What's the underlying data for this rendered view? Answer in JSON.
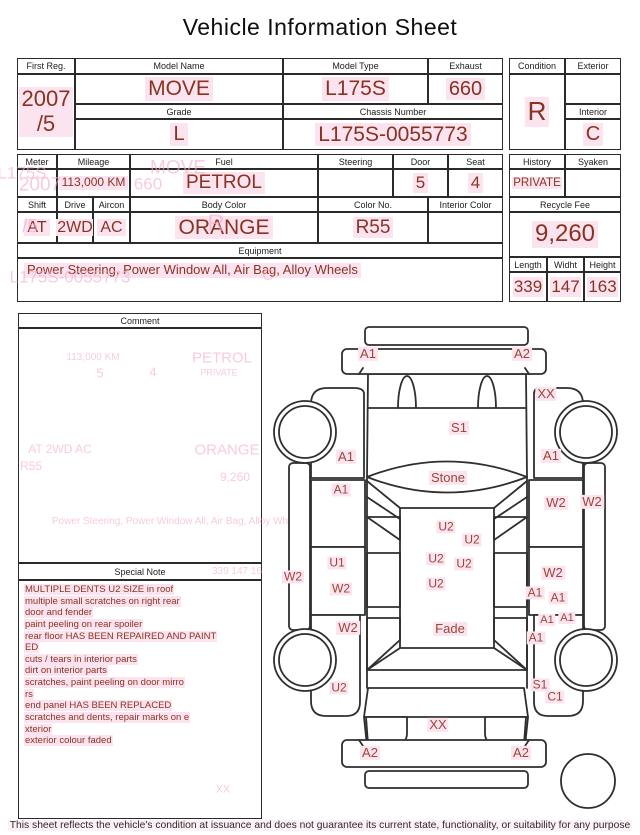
{
  "title": "Vehicle Information Sheet",
  "registration": {
    "first_reg": {
      "label": "First Reg.",
      "value": "2007\n/5"
    },
    "model_name": {
      "label": "Model Name",
      "value": "MOVE"
    },
    "model_type": {
      "label": "Model Type",
      "value": "L175S"
    },
    "exhaust": {
      "label": "Exhaust",
      "value": "660"
    },
    "grade": {
      "label": "Grade",
      "value": "L"
    },
    "chassis_number": {
      "label": "Chassis Number",
      "value": "L175S-0055773"
    },
    "condition": {
      "label": "Condition",
      "value": "R"
    },
    "exterior": {
      "label": "Exterior",
      "value": ""
    },
    "interior": {
      "label": "Interior",
      "value": "C"
    }
  },
  "details": {
    "meter": {
      "label": "Meter",
      "value": ""
    },
    "mileage": {
      "label": "Mileage",
      "value": "113,000 KM"
    },
    "fuel": {
      "label": "Fuel",
      "value": "PETROL"
    },
    "steering": {
      "label": "Steering",
      "value": ""
    },
    "door": {
      "label": "Door",
      "value": "5"
    },
    "seat": {
      "label": "Seat",
      "value": "4"
    },
    "shift": {
      "label": "Shift",
      "value": "AT"
    },
    "drive": {
      "label": "Drive",
      "value": "2WD"
    },
    "aircon": {
      "label": "Aircon",
      "value": "AC"
    },
    "body_color": {
      "label": "Body Color",
      "value": "ORANGE"
    },
    "color_no": {
      "label": "Color No.",
      "value": "R55"
    },
    "interior_color": {
      "label": "Interior Color",
      "value": ""
    },
    "equipment": {
      "label": "Equipment",
      "value": "Power Steering, Power Window  All, Air Bag, Alloy Wheels"
    },
    "history": {
      "label": "History",
      "value": "PRIVATE"
    },
    "syaken": {
      "label": "Syaken",
      "value": ""
    },
    "recycle_fee": {
      "label": "Recycle Fee",
      "value": "9,260"
    },
    "length": {
      "label": "Length",
      "value": "339"
    },
    "width": {
      "label": "Widht",
      "value": "147"
    },
    "height": {
      "label": "Height",
      "value": "163"
    }
  },
  "comment": {
    "label": "Comment"
  },
  "special_note": {
    "label": "Special Note",
    "lines": [
      "MULTIPLE DENTS U2 SIZE in roof",
      "multiple small scratches on right rear",
      " door and fender",
      "paint peeling on rear spoiler",
      "rear floor HAS BEEN REPAIRED AND PAINT",
      "ED",
      "cuts / tears in interior parts",
      "dirt on interior parts",
      "scratches, paint peeling on door mirro",
      "rs",
      "end panel HAS BEEN REPLACED",
      "scratches and dents, repair marks on e",
      "xterior",
      "exterior colour faded"
    ]
  },
  "footer": "This sheet reflects the vehicle's condition at issuance and does not guarantee its current state, functionality, or suitability for any purpose",
  "diagram": {
    "labels": [
      {
        "t": "A1",
        "x": 368,
        "y": 354,
        "s": 13
      },
      {
        "t": "A2",
        "x": 522,
        "y": 354,
        "s": 13
      },
      {
        "t": "XX",
        "x": 546,
        "y": 394,
        "s": 13
      },
      {
        "t": "S1",
        "x": 459,
        "y": 428,
        "s": 13
      },
      {
        "t": "A1",
        "x": 346,
        "y": 457,
        "s": 13
      },
      {
        "t": "A1",
        "x": 551,
        "y": 456,
        "s": 13
      },
      {
        "t": "A1",
        "x": 341,
        "y": 490,
        "s": 12
      },
      {
        "t": "Stone",
        "x": 448,
        "y": 478,
        "s": 13
      },
      {
        "t": "W2",
        "x": 556,
        "y": 503,
        "s": 13
      },
      {
        "t": "W2",
        "x": 592,
        "y": 502,
        "s": 13
      },
      {
        "t": "U2",
        "x": 446,
        "y": 527,
        "s": 12
      },
      {
        "t": "U2",
        "x": 472,
        "y": 540,
        "s": 12
      },
      {
        "t": "U2",
        "x": 436,
        "y": 559,
        "s": 12
      },
      {
        "t": "U2",
        "x": 464,
        "y": 564,
        "s": 12
      },
      {
        "t": "U1",
        "x": 337,
        "y": 563,
        "s": 12
      },
      {
        "t": "W2",
        "x": 293,
        "y": 577,
        "s": 12
      },
      {
        "t": "U2",
        "x": 436,
        "y": 584,
        "s": 12
      },
      {
        "t": "W2",
        "x": 341,
        "y": 589,
        "s": 12
      },
      {
        "t": "W2",
        "x": 553,
        "y": 573,
        "s": 13
      },
      {
        "t": "A1",
        "x": 535,
        "y": 593,
        "s": 12
      },
      {
        "t": "A1",
        "x": 558,
        "y": 598,
        "s": 12
      },
      {
        "t": "A1",
        "x": 547,
        "y": 620,
        "s": 11
      },
      {
        "t": "A1",
        "x": 567,
        "y": 618,
        "s": 11
      },
      {
        "t": "W2",
        "x": 348,
        "y": 628,
        "s": 13
      },
      {
        "t": "Fade",
        "x": 450,
        "y": 629,
        "s": 13
      },
      {
        "t": "A1",
        "x": 536,
        "y": 638,
        "s": 12
      },
      {
        "t": "U2",
        "x": 339,
        "y": 688,
        "s": 12
      },
      {
        "t": "S1",
        "x": 540,
        "y": 685,
        "s": 12
      },
      {
        "t": "C1",
        "x": 555,
        "y": 697,
        "s": 12
      },
      {
        "t": "XX",
        "x": 438,
        "y": 725,
        "s": 13
      },
      {
        "t": "A2",
        "x": 370,
        "y": 753,
        "s": 13
      },
      {
        "t": "A2",
        "x": 521,
        "y": 753,
        "s": 13
      }
    ]
  },
  "ghosts": [
    {
      "t": "L175S",
      "x": 22,
      "y": 173,
      "s": 17
    },
    {
      "t": "2007",
      "x": 40,
      "y": 185,
      "s": 19
    },
    {
      "t": "/5",
      "x": 30,
      "y": 227,
      "s": 19
    },
    {
      "t": "MOVE",
      "x": 178,
      "y": 168,
      "s": 19
    },
    {
      "t": "660",
      "x": 148,
      "y": 184,
      "s": 17
    },
    {
      "t": "R",
      "x": 216,
      "y": 224,
      "s": 24
    },
    {
      "t": "L175S-0055773",
      "x": 70,
      "y": 277,
      "s": 17
    },
    {
      "t": "C",
      "x": 268,
      "y": 276,
      "s": 16
    },
    {
      "t": "113,000 KM",
      "x": 93,
      "y": 358,
      "s": 10
    },
    {
      "t": "PETROL",
      "x": 222,
      "y": 358,
      "s": 15
    },
    {
      "t": "PRIVATE",
      "x": 219,
      "y": 373,
      "s": 9
    },
    {
      "t": "5",
      "x": 100,
      "y": 373,
      "s": 13
    },
    {
      "t": "4",
      "x": 153,
      "y": 372,
      "s": 13
    },
    {
      "t": "AT  2WD  AC",
      "x": 60,
      "y": 449,
      "s": 12
    },
    {
      "t": "ORANGE",
      "x": 227,
      "y": 450,
      "s": 15
    },
    {
      "t": "R55",
      "x": 31,
      "y": 466,
      "s": 12
    },
    {
      "t": "9,260",
      "x": 235,
      "y": 477,
      "s": 12
    },
    {
      "t": "Power Steering, Power Window  All, Air Bag, Alloy Wh",
      "x": 170,
      "y": 522,
      "s": 10
    },
    {
      "t": "339  147  16",
      "x": 237,
      "y": 572,
      "s": 10
    },
    {
      "t": "XX",
      "x": 223,
      "y": 790,
      "s": 11
    }
  ],
  "colors": {
    "value_text": "#8a3222",
    "label_text": "#9a4734",
    "highlight": "#fbe4ef",
    "ghost": "#f5aacb",
    "line": "#2f2f2f"
  }
}
